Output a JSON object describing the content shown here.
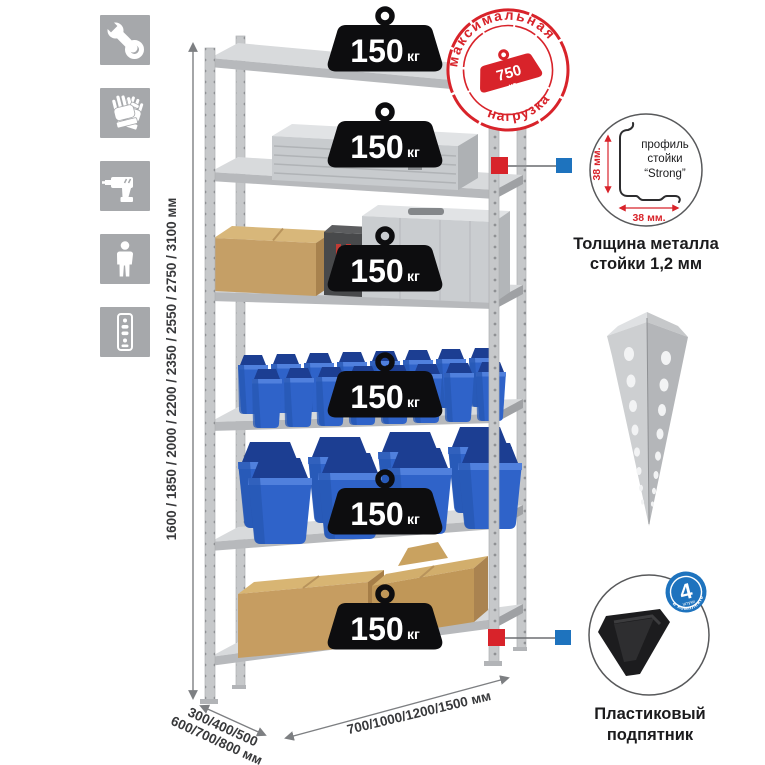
{
  "left_toolbar": {
    "icons": [
      {
        "name": "wrench-icon"
      },
      {
        "name": "gloves-icon"
      },
      {
        "name": "drill-icon"
      },
      {
        "name": "person-icon"
      },
      {
        "name": "rack-post-icon"
      }
    ]
  },
  "dimensions": {
    "height_label": "1600 / 1850 / 2000 / 2200 / 2350 / 2550 / 2750 / 3100 мм",
    "depth_label_line1": "300/400/500",
    "depth_label_line2": "600/700/800 мм",
    "width_label": "700/1000/1200/1500 мм"
  },
  "shelf_badges": [
    {
      "value": "150",
      "unit": "кг"
    },
    {
      "value": "150",
      "unit": "кг"
    },
    {
      "value": "150",
      "unit": "кг"
    },
    {
      "value": "150",
      "unit": "кг"
    },
    {
      "value": "150",
      "unit": "кг"
    },
    {
      "value": "150",
      "unit": "кг"
    }
  ],
  "max_load_stamp": {
    "arc_top": "максимальная",
    "arc_bottom": "нагрузка",
    "value": "750",
    "unit": "кг"
  },
  "profile_detail": {
    "label_line1": "профиль",
    "label_line2": "стойки",
    "label_line3": "“Strong”",
    "dim_vertical": "38 мм.",
    "dim_horizontal": "38 мм.",
    "caption_line1": "Толщина металла",
    "caption_line2": "стойки 1,2 мм"
  },
  "foot_detail": {
    "badge_value": "4",
    "badge_small": "штуки",
    "badge_arc": "в комплекте",
    "caption_line1": "Пластиковый",
    "caption_line2": "подпятник"
  },
  "colors": {
    "accent_red": "#d8232a",
    "accent_blue": "#1e73be",
    "icon_gray": "#a6a8ab",
    "bin_blue": "#2f63c9"
  }
}
